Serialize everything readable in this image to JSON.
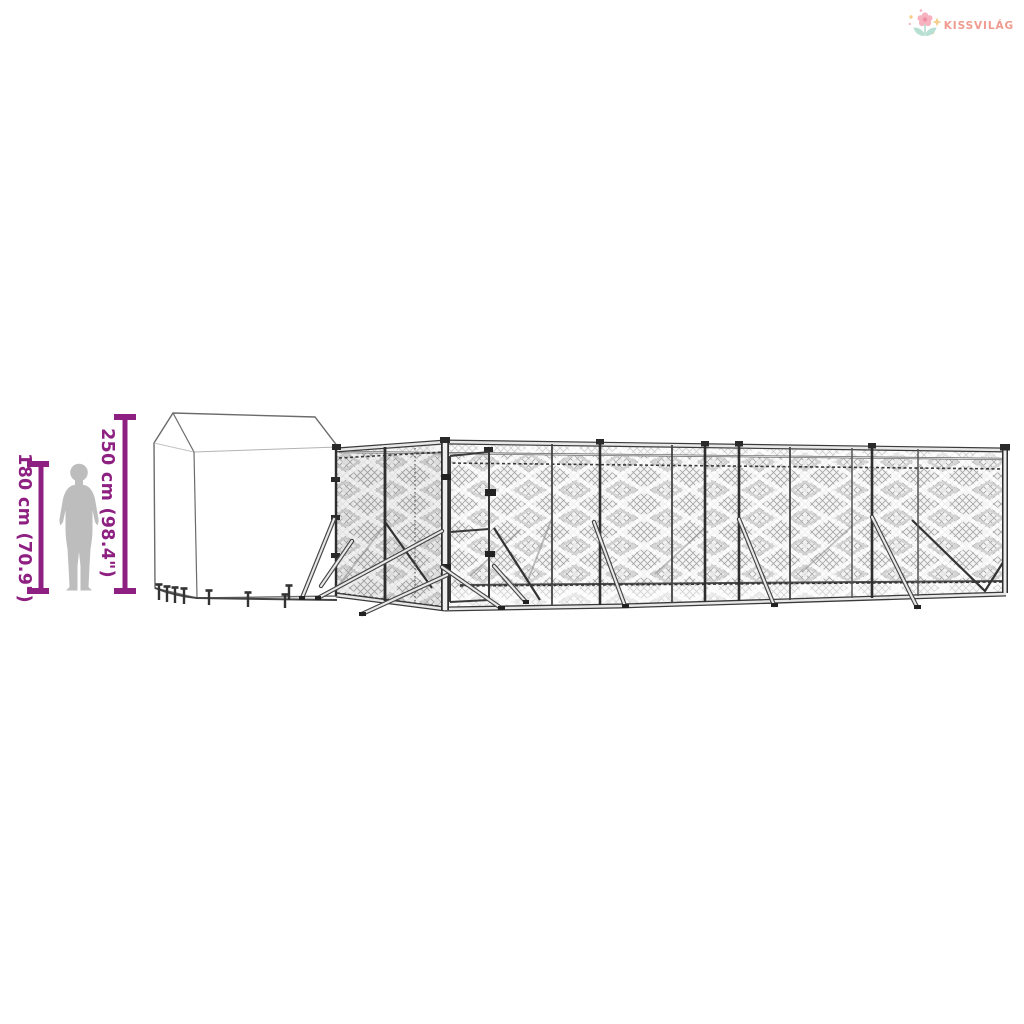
{
  "logo": {
    "brand": "KISSVILÁG",
    "brand_color": "#F19A8F",
    "icon": "flower-icon",
    "icon_colors": {
      "petals": "#F7B2C0",
      "center": "#F08FA4",
      "leaves": "#B7E0D3",
      "sparkle": "#F6CD8A"
    }
  },
  "dimensions": {
    "color": "#8E2082",
    "person_height_label": "180 cm (70.9\")",
    "structure_height_label": "250 cm (98.4\")"
  },
  "colors": {
    "background": "#FFFFFF",
    "person": "#BDBDBD",
    "structure_outline": "#3A3A3A",
    "mesh_line": "#A6A6A6",
    "mesh_background": "#F4F4F4",
    "tube_fill": "#E8E8E8"
  }
}
